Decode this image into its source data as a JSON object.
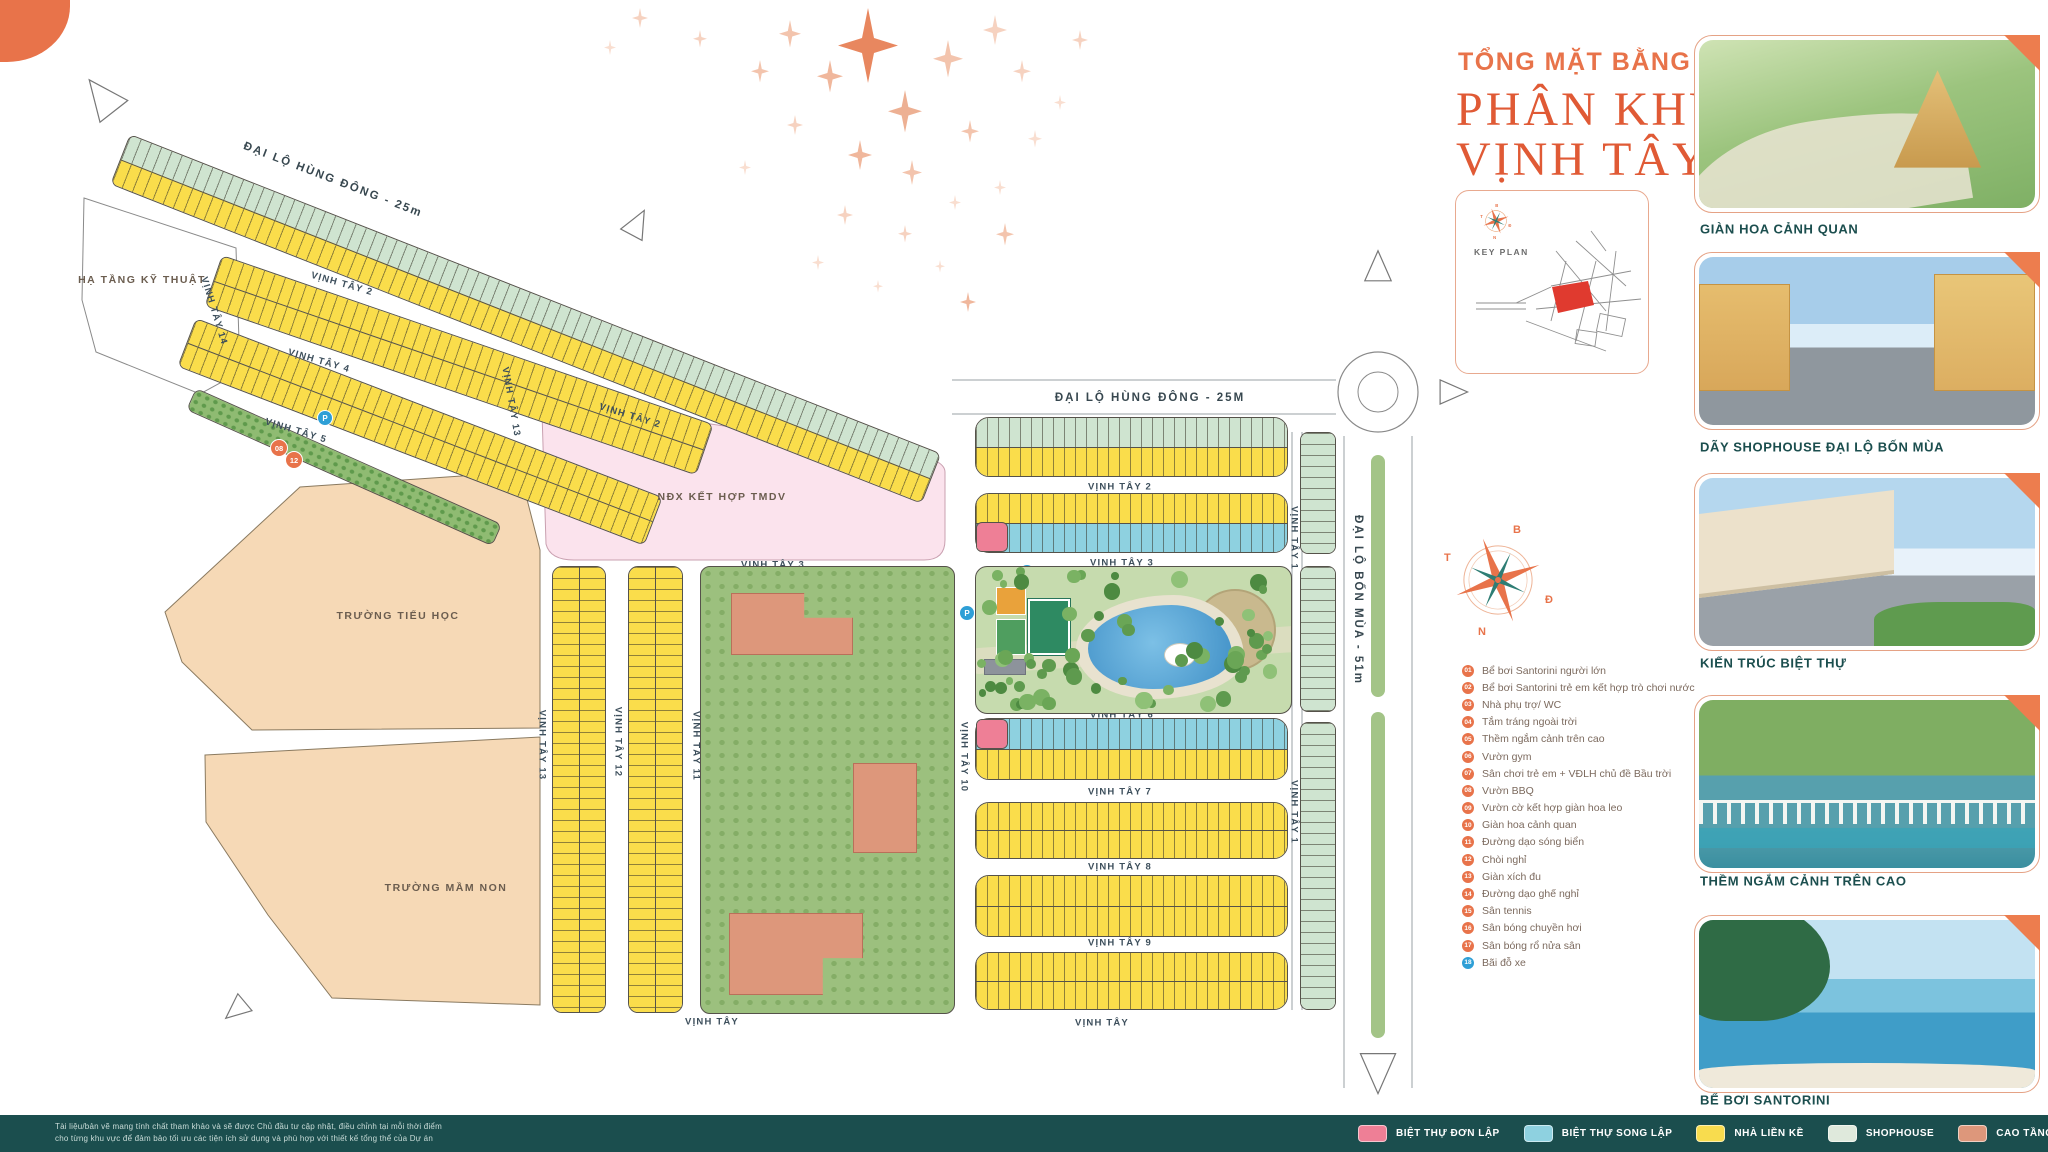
{
  "meta": {
    "accent": "#e8734a",
    "footer_bg": "#1b4e4e",
    "title_color": "#e05a35"
  },
  "title": {
    "eyebrow": "TỔNG MẶT BẰNG",
    "line1": "PHÂN KHU",
    "line2": "VỊNH TÂY"
  },
  "key_plan": {
    "label": "KEY PLAN",
    "highlight_color": "#e03a2f"
  },
  "compass": {
    "north": "B",
    "east": "Đ",
    "south": "N",
    "west": "T"
  },
  "amenity_legend": {
    "orange": "#e8734a",
    "blue": "#2e9fd6",
    "items": [
      {
        "num": "01",
        "label": "Bể bơi Santorini người lớn",
        "color": "#e8734a"
      },
      {
        "num": "02",
        "label": "Bể bơi Santorini trẻ em kết hợp trò chơi nước",
        "color": "#e8734a"
      },
      {
        "num": "03",
        "label": "Nhà phụ trợ/ WC",
        "color": "#e8734a"
      },
      {
        "num": "04",
        "label": "Tắm tráng ngoài trời",
        "color": "#e8734a"
      },
      {
        "num": "05",
        "label": "Thềm ngắm cảnh trên cao",
        "color": "#e8734a"
      },
      {
        "num": "06",
        "label": "Vườn gym",
        "color": "#e8734a"
      },
      {
        "num": "07",
        "label": "Sân chơi trẻ em + VĐLH chủ đề Bầu trời",
        "color": "#e8734a"
      },
      {
        "num": "08",
        "label": "Vườn BBQ",
        "color": "#e8734a"
      },
      {
        "num": "09",
        "label": "Vườn cờ kết hợp giàn hoa leo",
        "color": "#e8734a"
      },
      {
        "num": "10",
        "label": "Giàn hoa cảnh quan",
        "color": "#e8734a"
      },
      {
        "num": "11",
        "label": "Đường dạo sóng biển",
        "color": "#e8734a"
      },
      {
        "num": "12",
        "label": "Chòi nghỉ",
        "color": "#e8734a"
      },
      {
        "num": "13",
        "label": "Giàn xích đu",
        "color": "#e8734a"
      },
      {
        "num": "14",
        "label": "Đường dạo ghế nghỉ",
        "color": "#e8734a"
      },
      {
        "num": "15",
        "label": "Sân tennis",
        "color": "#e8734a"
      },
      {
        "num": "16",
        "label": "Sân bóng chuyền hơi",
        "color": "#e8734a"
      },
      {
        "num": "17",
        "label": "Sân bóng rổ nửa sân",
        "color": "#e8734a"
      },
      {
        "num": "18",
        "label": "Bãi đỗ xe",
        "color": "#2e9fd6"
      }
    ]
  },
  "photos": [
    {
      "caption": "GIÀN HOA CẢNH QUAN"
    },
    {
      "caption": "DÃY SHOPHOUSE ĐẠI LỘ BỐN MÙA"
    },
    {
      "caption": "KIẾN TRÚC BIỆT THỰ"
    },
    {
      "caption": "THỀM NGẮM CẢNH TRÊN CAO"
    },
    {
      "caption": "BỂ BƠI SANTORINI"
    }
  ],
  "map": {
    "palette": {
      "lk": "#fadd4b",
      "sh": "#cfe4d0",
      "song": "#8ed1e0",
      "don": "#ee7f96",
      "cao": "#dd977b",
      "park": "#8fbb72"
    },
    "road_labels": [
      {
        "t": "ĐẠI LỘ HÙNG ĐÔNG - 25m",
        "x": 333,
        "y": 180,
        "r": 21
      },
      {
        "t": "ĐẠI LỘ HÙNG ĐÔNG - 25M",
        "x": 1150,
        "y": 398,
        "r": 0
      },
      {
        "t": "ĐẠI LỘ BỐN MÙA - 51m",
        "x": 1358,
        "y": 600,
        "r": 90
      }
    ],
    "street_labels": [
      {
        "t": "VỊNH TÂY 2",
        "x": 342,
        "y": 284,
        "r": 16
      },
      {
        "t": "VỊNH TÂY 4",
        "x": 319,
        "y": 361,
        "r": 16
      },
      {
        "t": "VỊNH TÂY 5",
        "x": 296,
        "y": 431,
        "r": 17
      },
      {
        "t": "VỊNH TÂY 2",
        "x": 630,
        "y": 416,
        "r": 17
      },
      {
        "t": "VỊNH TÂY 14",
        "x": 214,
        "y": 311,
        "r": 73
      },
      {
        "t": "VỊNH TÂY 13",
        "x": 511,
        "y": 402,
        "r": 80
      },
      {
        "t": "VỊNH TÂY 13",
        "x": 542,
        "y": 745,
        "r": 90
      },
      {
        "t": "VỊNH TÂY 12",
        "x": 618,
        "y": 742,
        "r": 90
      },
      {
        "t": "VỊNH TÂY 11",
        "x": 696,
        "y": 746,
        "r": 90
      },
      {
        "t": "VỊNH TÂY 10",
        "x": 964,
        "y": 757,
        "r": 90
      },
      {
        "t": "VỊNH TÂY 1",
        "x": 1294,
        "y": 538,
        "r": 90
      },
      {
        "t": "VỊNH TÂY 1",
        "x": 1294,
        "y": 812,
        "r": 90
      },
      {
        "t": "VỊNH TÂY 2",
        "x": 1120,
        "y": 487,
        "r": 0
      },
      {
        "t": "VỊNH TÂY 3",
        "x": 773,
        "y": 565,
        "r": 0
      },
      {
        "t": "VỊNH TÂY 3",
        "x": 1122,
        "y": 563,
        "r": 0
      },
      {
        "t": "VỊNH TÂY 6",
        "x": 1122,
        "y": 715,
        "r": 0
      },
      {
        "t": "VỊNH TÂY 7",
        "x": 1120,
        "y": 792,
        "r": 0
      },
      {
        "t": "VỊNH TÂY 8",
        "x": 1120,
        "y": 867,
        "r": 0
      },
      {
        "t": "VỊNH TÂY 9",
        "x": 1120,
        "y": 943,
        "r": 0
      },
      {
        "t": "VỊNH TÂY",
        "x": 712,
        "y": 1022,
        "r": 0
      },
      {
        "t": "VỊNH TÂY",
        "x": 1102,
        "y": 1023,
        "r": 0
      }
    ],
    "area_labels": [
      {
        "t": "HẠ TẦNG KỸ THUẬT",
        "x": 142,
        "y": 280
      },
      {
        "t": "NĐX KẾT HỢP TMDV",
        "x": 722,
        "y": 497
      },
      {
        "t": "TRƯỜNG TIỂU HỌC",
        "x": 398,
        "y": 616
      },
      {
        "t": "TRƯỜNG MẦM NON",
        "x": 446,
        "y": 888
      }
    ],
    "blocks": [
      {
        "x": 130,
        "y": 134,
        "w": 872,
        "h": 54,
        "r": 21.5,
        "rows": [
          "sh",
          "lk"
        ]
      },
      {
        "x": 222,
        "y": 255,
        "w": 520,
        "h": 54,
        "r": 19,
        "rows": [
          "lk",
          "lk"
        ]
      },
      {
        "x": 196,
        "y": 318,
        "w": 500,
        "h": 52,
        "r": 21,
        "rows": [
          "lk",
          "lk"
        ]
      },
      {
        "x": 196,
        "y": 388,
        "w": 335,
        "h": 24,
        "r": 24,
        "rows": [
          "park"
        ]
      },
      {
        "x": 975,
        "y": 417,
        "w": 313,
        "h": 60,
        "r": 0,
        "rows": [
          "sh",
          "lk"
        ],
        "rad": 14
      },
      {
        "x": 975,
        "y": 493,
        "w": 313,
        "h": 60,
        "r": 0,
        "rows": [
          "lk",
          "song"
        ],
        "rad": 14
      },
      {
        "x": 976,
        "y": 522,
        "w": 32,
        "h": 30,
        "r": 0,
        "rows": [
          "don"
        ],
        "rad": 6
      },
      {
        "x": 975,
        "y": 718,
        "w": 313,
        "h": 62,
        "r": 0,
        "rows": [
          "song",
          "lk"
        ],
        "rad": 14
      },
      {
        "x": 976,
        "y": 719,
        "w": 32,
        "h": 30,
        "r": 0,
        "rows": [
          "don"
        ],
        "rad": 6
      },
      {
        "x": 975,
        "y": 802,
        "w": 313,
        "h": 57,
        "r": 0,
        "rows": [
          "lk",
          "lk"
        ],
        "rad": 14
      },
      {
        "x": 975,
        "y": 875,
        "w": 313,
        "h": 62,
        "r": 0,
        "rows": [
          "lk",
          "lk"
        ],
        "rad": 14
      },
      {
        "x": 975,
        "y": 952,
        "w": 313,
        "h": 58,
        "r": 0,
        "rows": [
          "lk",
          "lk"
        ],
        "rad": 14
      },
      {
        "x": 552,
        "y": 566,
        "w": 54,
        "h": 447,
        "r": 0,
        "rows": [
          "lk",
          "lk"
        ],
        "v": true,
        "rad": 10
      },
      {
        "x": 628,
        "y": 566,
        "w": 55,
        "h": 447,
        "r": 0,
        "rows": [
          "lk",
          "lk"
        ],
        "v": true,
        "rad": 10
      },
      {
        "x": 1300,
        "y": 432,
        "w": 36,
        "h": 122,
        "r": 0,
        "rows": [
          "sh"
        ],
        "v": true,
        "rad": 8
      },
      {
        "x": 1300,
        "y": 566,
        "w": 36,
        "h": 146,
        "r": 0,
        "rows": [
          "sh"
        ],
        "v": true,
        "rad": 8
      },
      {
        "x": 1300,
        "y": 722,
        "w": 36,
        "h": 288,
        "r": 0,
        "rows": [
          "sh"
        ],
        "v": true,
        "rad": 8
      }
    ],
    "markers": [
      {
        "t": "P",
        "x": 325,
        "y": 418,
        "k": "p"
      },
      {
        "t": "08",
        "x": 279,
        "y": 448,
        "k": "o"
      },
      {
        "t": "12",
        "x": 294,
        "y": 460,
        "k": "o"
      },
      {
        "t": "P",
        "x": 1027,
        "y": 572,
        "k": "p"
      },
      {
        "t": "P",
        "x": 1125,
        "y": 573,
        "k": "p"
      },
      {
        "t": "14",
        "x": 1019,
        "y": 583,
        "k": "o"
      },
      {
        "t": "10",
        "x": 1080,
        "y": 593,
        "k": "o"
      },
      {
        "t": "09",
        "x": 1127,
        "y": 595,
        "k": "o"
      },
      {
        "t": "14",
        "x": 1237,
        "y": 583,
        "k": "o"
      },
      {
        "t": "16",
        "x": 1011,
        "y": 602,
        "k": "o"
      },
      {
        "t": "02",
        "x": 1156,
        "y": 620,
        "k": "o"
      },
      {
        "t": "08",
        "x": 1231,
        "y": 617,
        "k": "o"
      },
      {
        "t": "P",
        "x": 967,
        "y": 613,
        "k": "p"
      },
      {
        "t": "P",
        "x": 1282,
        "y": 613,
        "k": "p"
      },
      {
        "t": "15",
        "x": 1047,
        "y": 623,
        "k": "o"
      },
      {
        "t": "17",
        "x": 1009,
        "y": 630,
        "k": "o"
      },
      {
        "t": "04",
        "x": 1182,
        "y": 630,
        "k": "o"
      },
      {
        "t": "01",
        "x": 1133,
        "y": 637,
        "k": "o"
      },
      {
        "t": "03",
        "x": 1175,
        "y": 654,
        "k": "o"
      },
      {
        "t": "12",
        "x": 1062,
        "y": 663,
        "k": "o"
      },
      {
        "t": "05",
        "x": 1121,
        "y": 667,
        "k": "o"
      },
      {
        "t": "06",
        "x": 1002,
        "y": 676,
        "k": "o"
      },
      {
        "t": "13",
        "x": 1123,
        "y": 683,
        "k": "o"
      },
      {
        "t": "11",
        "x": 1100,
        "y": 684,
        "k": "o"
      },
      {
        "t": "10",
        "x": 1172,
        "y": 688,
        "k": "o"
      },
      {
        "t": "07",
        "x": 1226,
        "y": 673,
        "k": "o"
      },
      {
        "t": "12",
        "x": 1261,
        "y": 681,
        "k": "o"
      },
      {
        "t": "14",
        "x": 1237,
        "y": 692,
        "k": "o"
      },
      {
        "t": "P",
        "x": 1282,
        "y": 672,
        "k": "p"
      },
      {
        "t": "P",
        "x": 1025,
        "y": 706,
        "k": "p"
      },
      {
        "t": "P",
        "x": 1123,
        "y": 706,
        "k": "p"
      }
    ]
  },
  "footer": {
    "disclaimer_line1": "Tài liệu/bản vẽ mang tính chất tham khảo và sẽ được Chủ đầu tư cập nhật, điều chỉnh tại mỗi thời điểm",
    "disclaimer_line2": "cho từng khu vực để đảm bảo tối ưu các tiện ích sử dụng và phù hợp với thiết kế tổng thể của Dự án",
    "legend": [
      {
        "label": "BIỆT THỰ ĐƠN LẬP",
        "color": "#ee7f96"
      },
      {
        "label": "BIỆT THỰ SONG LẬP",
        "color": "#8ed1e0"
      },
      {
        "label": "NHÀ LIỀN KỀ",
        "color": "#f8dc4e"
      },
      {
        "label": "SHOPHOUSE",
        "color": "#dfe9dc"
      },
      {
        "label": "CAO TẦNG",
        "color": "#dd977b"
      }
    ]
  }
}
